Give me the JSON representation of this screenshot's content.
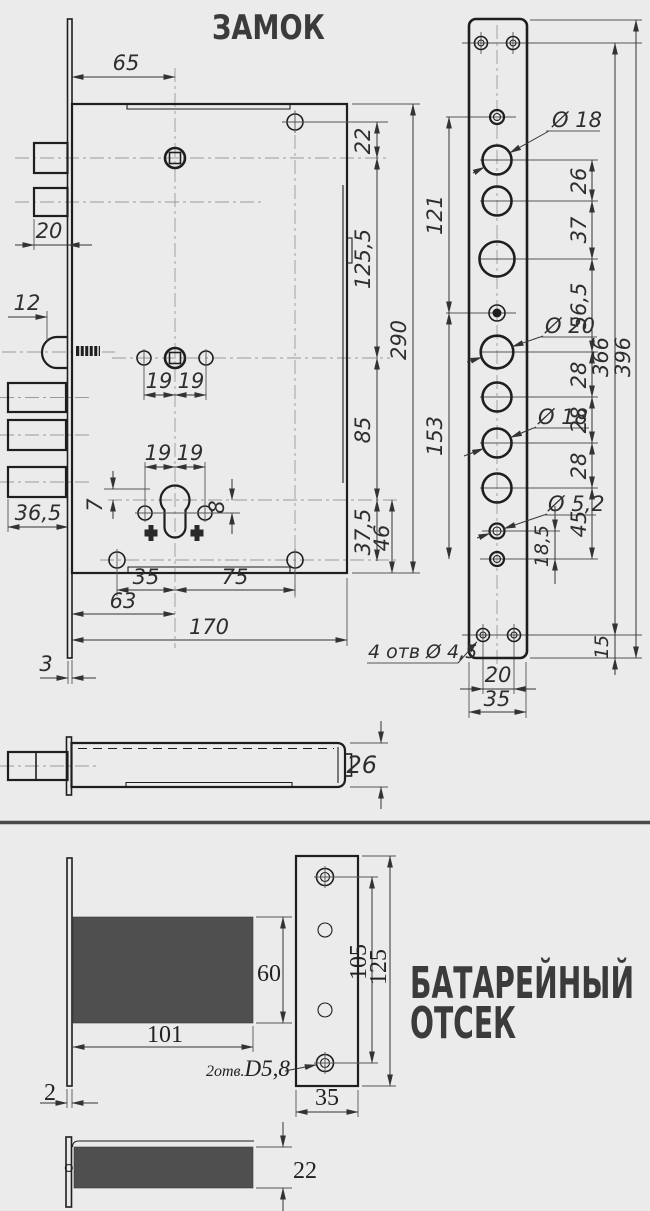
{
  "colors": {
    "background": "#ebebeb",
    "line": "#222222",
    "dark_fill": "#4f4f4f",
    "title_text": "#3b3b3b"
  },
  "titles": {
    "main": "ЗАМОК",
    "battery_line1": "БАТАРЕЙНЫЙ",
    "battery_line2": "ОТСЕК"
  },
  "lock": {
    "d65": "65",
    "d22": "22",
    "d20": "20",
    "d12": "12",
    "d125_5": "125,5",
    "d85": "85",
    "d290": "290",
    "d19": "19",
    "d7": "7",
    "d8": "8",
    "d36_5": "36,5",
    "d37_5": "37,5",
    "d46": "46",
    "d35": "35",
    "d75": "75",
    "d63": "63",
    "d170": "170",
    "d3": "3",
    "d26": "26"
  },
  "plate": {
    "d121": "121",
    "d153": "153",
    "d366": "366",
    "d396": "396",
    "d26": "26",
    "d37": "37",
    "d56_5": "56,5",
    "d28": "28",
    "d45": "45",
    "d18_5": "18,5",
    "d15": "15",
    "d20": "20",
    "d35": "35",
    "dia18": "Ø 18",
    "dia20": "Ø 20",
    "dia5_2": "Ø 5,2",
    "note_4holes": "4 отв Ø 4,5"
  },
  "battery": {
    "d60": "60",
    "d101": "101",
    "d2": "2",
    "d105": "105",
    "d125": "125",
    "d35": "35",
    "d22": "22",
    "note_prefix": "2отв.",
    "note_size": "D5,8"
  }
}
